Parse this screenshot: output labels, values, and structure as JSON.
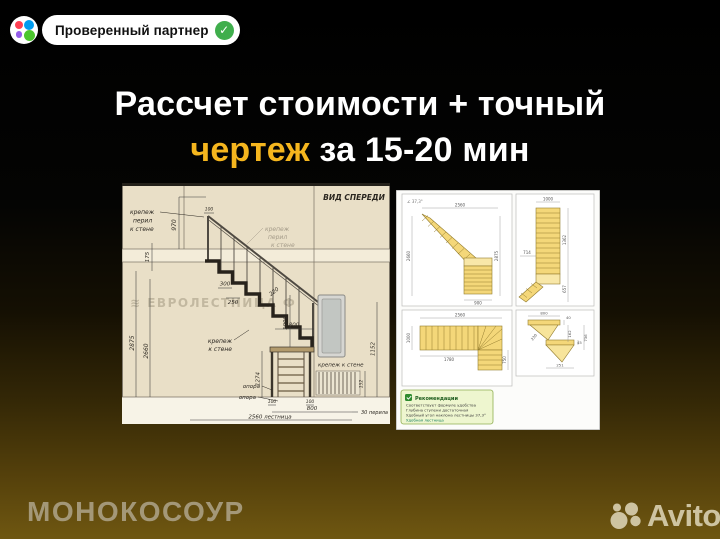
{
  "badge": {
    "label": "Проверенный партнер",
    "check": "✓"
  },
  "headline": {
    "line1": "Рассчет стоимости + точный",
    "highlight": "чертеж",
    "rest": " за 15-20 мин"
  },
  "colors": {
    "highlight_yellow": "#f5b61e",
    "badge_check_green": "#3fae4c",
    "avito_red": "#ff4053",
    "avito_blue": "#009cf0",
    "avito_purple": "#965eeb",
    "avito_green": "#4cc62e",
    "step_yellow": "#f4d779",
    "bg_gold": "#6f5711"
  },
  "left_drawing": {
    "view_label": "ВИД СПЕРЕДИ",
    "watermark": "≋ ЕВРОЛЕСТНИЦА Ф",
    "labels": {
      "rail_wall_top": [
        "крепеж",
        "перил",
        "к стене"
      ],
      "rail_wall_mid": [
        "крепеж",
        "перил",
        "к стене"
      ],
      "wall_fix_left": [
        "крепеж",
        "к стене"
      ],
      "wall_fix_right": "крепеж к стене",
      "support_upper": "опора",
      "support_lower": "опора",
      "railing_note": "30 перила",
      "total_note": "2560 лестница"
    },
    "dims": {
      "post_offset": "100",
      "rail_height": "970",
      "slab_thickness": "175",
      "total_height": "2875",
      "clear_height": "2660",
      "tread_depth": "300",
      "step_run": "250",
      "rail_offset": "220",
      "rail_post_height": "1000",
      "door_gap": "800",
      "lower_height": "1274",
      "wall_height": "1152",
      "radiator_height": "152",
      "base_left": "100",
      "base_right": "100",
      "base_span": "800"
    }
  },
  "right_drawing": {
    "top_left": {
      "angle_note": "∠ 37,3°",
      "top": "2560",
      "left": "2660",
      "right": "2875",
      "bottom": "900"
    },
    "top_right": {
      "top": "1000",
      "left": "714",
      "right_upper": "1362",
      "right_lower": "657"
    },
    "bottom_left": {
      "top": "2560",
      "left": "1000",
      "inner": "1780",
      "right": "750"
    },
    "bottom_right": {
      "top": "800",
      "d2": "40",
      "d3": "162",
      "d4": "736",
      "d5": "230",
      "d6": "45",
      "bottom": "251"
    },
    "recommendations": {
      "title": "Рекомендации",
      "items": [
        "Соответствует формуле удобства",
        "Глубина ступени достаточная",
        "Удобный угол наклона лестницы 37,3°",
        "Удобная лестница"
      ]
    }
  },
  "footer": {
    "brand": "МОНОКОСОУР",
    "avito": "Avito"
  }
}
